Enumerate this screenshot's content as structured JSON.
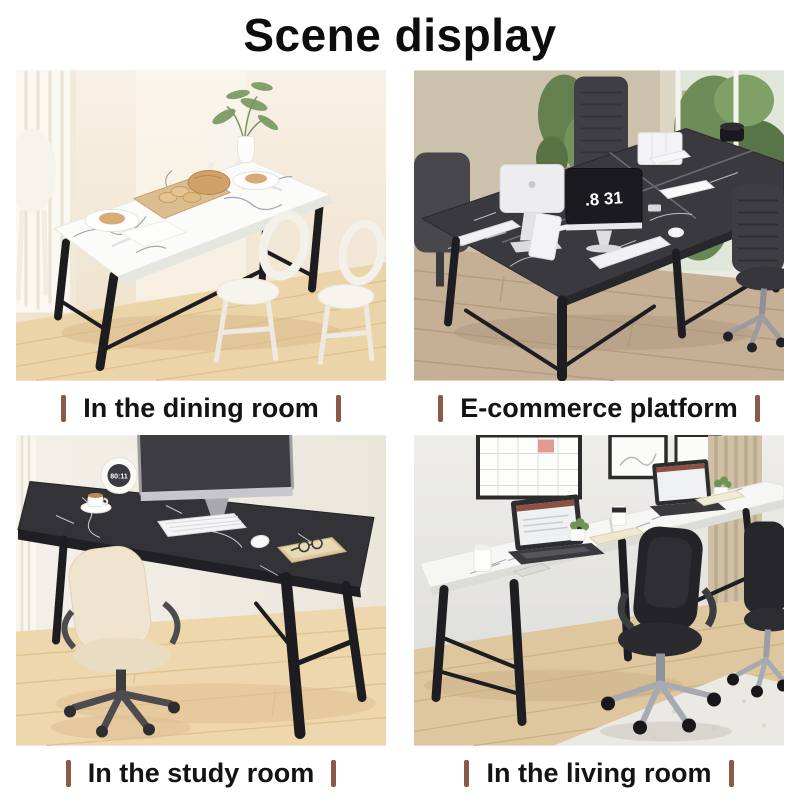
{
  "page": {
    "title": "Scene display"
  },
  "colors": {
    "background": "#ffffff",
    "title_text": "#0d0d0d",
    "caption_text": "#141414",
    "caption_bar": "#8a5a49"
  },
  "scenes": [
    {
      "caption": "In the dining room"
    },
    {
      "caption": "E-commerce platform",
      "monitor_time": ".8 31"
    },
    {
      "caption": "In the study room",
      "clock_time": "80:11"
    },
    {
      "caption": "In the living room"
    }
  ]
}
